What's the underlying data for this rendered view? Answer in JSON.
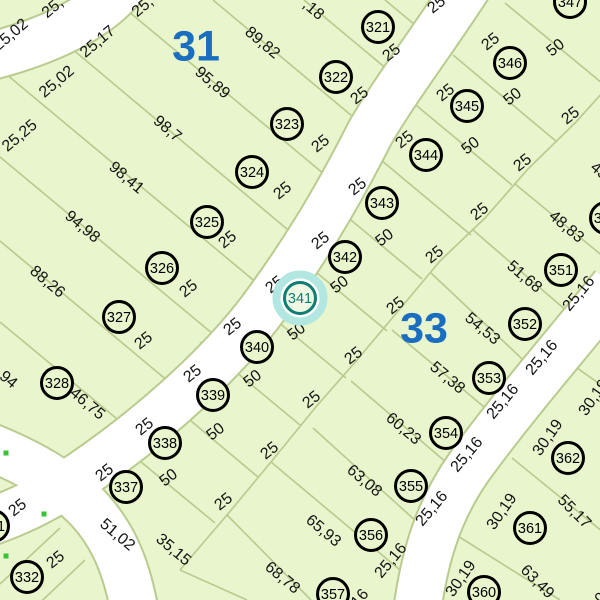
{
  "map": {
    "type": "cadastral-parcel-map",
    "colors": {
      "parcel_fill": "#e9f5cd",
      "lot_line": "#b9cb8f",
      "street_fill": "#ffffff",
      "street_casing": "#b9cb8f",
      "text": "#141414",
      "circle_stroke": "#000000",
      "block_number": "#1a6ebf",
      "highlight_halo": "#b2e6e0",
      "highlight_ring": "#0e7d74",
      "highlight_fill": "#eef8e2",
      "vertex_dot": "#35c435"
    },
    "selected_parcel": "341",
    "blocks": [
      {
        "label": "31",
        "x": 196,
        "y": 45
      },
      {
        "label": "33",
        "x": 424,
        "y": 327
      }
    ],
    "parcels": [
      {
        "number": "321",
        "x": 378,
        "y": 27
      },
      {
        "number": "322",
        "x": 336,
        "y": 77
      },
      {
        "number": "323",
        "x": 287,
        "y": 124
      },
      {
        "number": "324",
        "x": 252,
        "y": 172
      },
      {
        "number": "325",
        "x": 207,
        "y": 222
      },
      {
        "number": "326",
        "x": 162,
        "y": 268
      },
      {
        "number": "327",
        "x": 119,
        "y": 317
      },
      {
        "number": "328",
        "x": 57,
        "y": 383
      },
      {
        "number": "331",
        "x": -7,
        "y": 526
      },
      {
        "number": "332",
        "x": 27,
        "y": 577
      },
      {
        "number": "337",
        "x": 126,
        "y": 487
      },
      {
        "number": "338",
        "x": 165,
        "y": 443
      },
      {
        "number": "339",
        "x": 213,
        "y": 395
      },
      {
        "number": "340",
        "x": 257,
        "y": 347
      },
      {
        "number": "341",
        "x": 300,
        "y": 298,
        "highlighted": true
      },
      {
        "number": "342",
        "x": 345,
        "y": 257
      },
      {
        "number": "343",
        "x": 382,
        "y": 203
      },
      {
        "number": "344",
        "x": 426,
        "y": 155
      },
      {
        "number": "345",
        "x": 467,
        "y": 106
      },
      {
        "number": "346",
        "x": 510,
        "y": 63
      },
      {
        "number": "347",
        "x": 570,
        "y": 2
      },
      {
        "number": "350",
        "x": 606,
        "y": 218
      },
      {
        "number": "351",
        "x": 561,
        "y": 270
      },
      {
        "number": "352",
        "x": 525,
        "y": 324
      },
      {
        "number": "353",
        "x": 489,
        "y": 378
      },
      {
        "number": "354",
        "x": 446,
        "y": 433
      },
      {
        "number": "355",
        "x": 411,
        "y": 486
      },
      {
        "number": "356",
        "x": 371,
        "y": 535
      },
      {
        "number": "357",
        "x": 333,
        "y": 594
      },
      {
        "number": "360",
        "x": 484,
        "y": 592
      },
      {
        "number": "361",
        "x": 530,
        "y": 528
      },
      {
        "number": "362",
        "x": 568,
        "y": 458
      }
    ],
    "dimension_labels": [
      {
        "text": "25,",
        "x": 52,
        "y": 7,
        "rot": -40
      },
      {
        "text": "25,02",
        "x": 10,
        "y": 34,
        "rot": -40
      },
      {
        "text": "25,",
        "x": 142,
        "y": 6,
        "rot": -40
      },
      {
        "text": "25,17",
        "x": 97,
        "y": 41,
        "rot": -40
      },
      {
        "text": "25,02",
        "x": 56,
        "y": 81,
        "rot": -40
      },
      {
        "text": "25,25",
        "x": 19,
        "y": 135,
        "rot": -40
      },
      {
        "text": ",18",
        "x": 314,
        "y": 9,
        "rot": 40
      },
      {
        "text": "89,82",
        "x": 263,
        "y": 42,
        "rot": 40
      },
      {
        "text": "95,89",
        "x": 213,
        "y": 82,
        "rot": 40
      },
      {
        "text": "98,7",
        "x": 168,
        "y": 128,
        "rot": 40
      },
      {
        "text": "98,41",
        "x": 127,
        "y": 177,
        "rot": 40
      },
      {
        "text": "94,98",
        "x": 83,
        "y": 226,
        "rot": 40
      },
      {
        "text": "88,26",
        "x": 48,
        "y": 281,
        "rot": 40
      },
      {
        "text": "94",
        "x": 9,
        "y": 379,
        "rot": 40
      },
      {
        "text": "46,75",
        "x": 88,
        "y": 403,
        "rot": 40
      },
      {
        "text": "51,02",
        "x": 118,
        "y": 534,
        "rot": 40
      },
      {
        "text": "35,15",
        "x": 174,
        "y": 549,
        "rot": 40
      },
      {
        "text": "25",
        "x": 436,
        "y": 4,
        "rot": -38
      },
      {
        "text": "25",
        "x": 391,
        "y": 52,
        "rot": -38
      },
      {
        "text": "25",
        "x": 359,
        "y": 95,
        "rot": -38
      },
      {
        "text": "25",
        "x": 320,
        "y": 143,
        "rot": -38
      },
      {
        "text": "25",
        "x": 282,
        "y": 190,
        "rot": -38
      },
      {
        "text": "25",
        "x": 227,
        "y": 239,
        "rot": -38
      },
      {
        "text": "25",
        "x": 188,
        "y": 288,
        "rot": -38
      },
      {
        "text": "25",
        "x": 143,
        "y": 340,
        "rot": -38
      },
      {
        "text": "25",
        "x": 490,
        "y": 41,
        "rot": -38
      },
      {
        "text": "25",
        "x": 445,
        "y": 92,
        "rot": -38
      },
      {
        "text": "25",
        "x": 404,
        "y": 139,
        "rot": -38
      },
      {
        "text": "25",
        "x": 357,
        "y": 186,
        "rot": -38
      },
      {
        "text": "25",
        "x": 320,
        "y": 240,
        "rot": -38
      },
      {
        "text": "25",
        "x": 274,
        "y": 284,
        "rot": -38
      },
      {
        "text": "25",
        "x": 232,
        "y": 326,
        "rot": -38
      },
      {
        "text": "25",
        "x": 192,
        "y": 373,
        "rot": -38
      },
      {
        "text": "25",
        "x": 144,
        "y": 426,
        "rot": -38
      },
      {
        "text": "25",
        "x": 104,
        "y": 472,
        "rot": -38
      },
      {
        "text": "50",
        "x": 555,
        "y": 47,
        "rot": -38
      },
      {
        "text": "50",
        "x": 512,
        "y": 96,
        "rot": -38
      },
      {
        "text": "50",
        "x": 470,
        "y": 145,
        "rot": -38
      },
      {
        "text": "50",
        "x": 384,
        "y": 237,
        "rot": -38
      },
      {
        "text": "50",
        "x": 339,
        "y": 284,
        "rot": -38
      },
      {
        "text": "50",
        "x": 296,
        "y": 331,
        "rot": -38
      },
      {
        "text": "50",
        "x": 252,
        "y": 378,
        "rot": -38
      },
      {
        "text": "50",
        "x": 215,
        "y": 431,
        "rot": -38
      },
      {
        "text": "50",
        "x": 168,
        "y": 477,
        "rot": -38
      },
      {
        "text": "25",
        "x": 570,
        "y": 115,
        "rot": -38
      },
      {
        "text": "25",
        "x": 522,
        "y": 162,
        "rot": -38
      },
      {
        "text": "25",
        "x": 479,
        "y": 211,
        "rot": -38
      },
      {
        "text": "25",
        "x": 434,
        "y": 254,
        "rot": -38
      },
      {
        "text": "25",
        "x": 395,
        "y": 305,
        "rot": -38
      },
      {
        "text": "25",
        "x": 353,
        "y": 355,
        "rot": -38
      },
      {
        "text": "25",
        "x": 311,
        "y": 399,
        "rot": -38
      },
      {
        "text": "25",
        "x": 269,
        "y": 450,
        "rot": -38
      },
      {
        "text": "25",
        "x": 223,
        "y": 501,
        "rot": -38
      },
      {
        "text": "43",
        "x": 600,
        "y": 170,
        "rot": 40
      },
      {
        "text": "48,83",
        "x": 567,
        "y": 226,
        "rot": 40
      },
      {
        "text": "51,68",
        "x": 525,
        "y": 276,
        "rot": 40
      },
      {
        "text": "54,53",
        "x": 483,
        "y": 328,
        "rot": 40
      },
      {
        "text": "57,38",
        "x": 448,
        "y": 377,
        "rot": 40
      },
      {
        "text": "60,23",
        "x": 404,
        "y": 428,
        "rot": 40
      },
      {
        "text": "63,08",
        "x": 365,
        "y": 480,
        "rot": 40
      },
      {
        "text": "65,93",
        "x": 324,
        "y": 530,
        "rot": 40
      },
      {
        "text": "68,78",
        "x": 283,
        "y": 577,
        "rot": 40
      },
      {
        "text": "25,16",
        "x": 578,
        "y": 293,
        "rot": -50
      },
      {
        "text": "25,16",
        "x": 541,
        "y": 357,
        "rot": -50
      },
      {
        "text": "25,16",
        "x": 502,
        "y": 401,
        "rot": -50
      },
      {
        "text": "25,16",
        "x": 466,
        "y": 454,
        "rot": -50
      },
      {
        "text": "25,16",
        "x": 431,
        "y": 508,
        "rot": -50
      },
      {
        "text": "25,16",
        "x": 390,
        "y": 560,
        "rot": -50
      },
      {
        "text": "25,16",
        "x": 352,
        "y": 606,
        "rot": -50
      },
      {
        "text": "30,19",
        "x": 593,
        "y": 397,
        "rot": -55
      },
      {
        "text": "30,19",
        "x": 547,
        "y": 437,
        "rot": -55
      },
      {
        "text": "30,19",
        "x": 501,
        "y": 511,
        "rot": -55
      },
      {
        "text": "30,19",
        "x": 460,
        "y": 578,
        "rot": -55
      },
      {
        "text": "30,19",
        "x": 604,
        "y": 592,
        "rot": -55
      },
      {
        "text": "55,17",
        "x": 575,
        "y": 511,
        "rot": 45
      },
      {
        "text": "63,49",
        "x": 538,
        "y": 581,
        "rot": 45
      },
      {
        "text": "25",
        "x": 17,
        "y": 507,
        "rot": -38
      },
      {
        "text": "25",
        "x": 55,
        "y": 559,
        "rot": -38
      }
    ],
    "vertex_dots": [
      {
        "x": 6,
        "y": 453
      },
      {
        "x": 44,
        "y": 514
      },
      {
        "x": 6,
        "y": 556
      }
    ]
  }
}
